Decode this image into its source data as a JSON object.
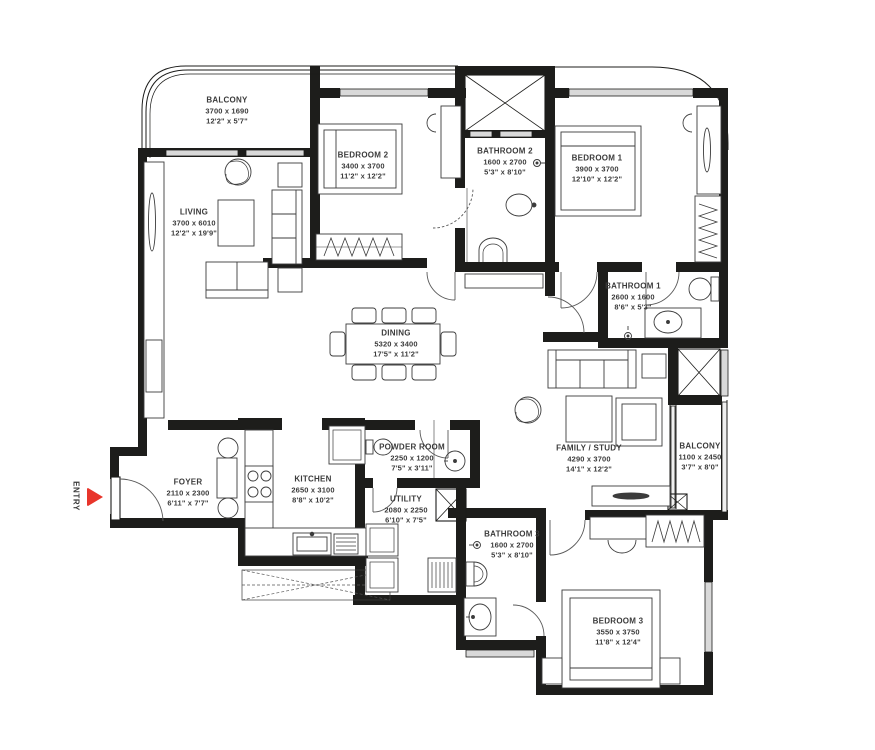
{
  "title": "Apartment floor plan",
  "colors": {
    "wall": "#1d1d1b",
    "text": "#3b3b3b",
    "window_fill": "#d9d9d9",
    "entry_red": "#e8352b"
  },
  "entry": {
    "label": "ENTRY"
  },
  "rooms": [
    {
      "id": "balcony-top",
      "name": "BALCONY",
      "metric": "3700 x 1690",
      "imperial": "12'2\" x 5'7\""
    },
    {
      "id": "bedroom-2",
      "name": "BEDROOM 2",
      "metric": "3400 x 3700",
      "imperial": "11'2\" x 12'2\""
    },
    {
      "id": "bathroom-2",
      "name": "BATHROOM 2",
      "metric": "1600 x 2700",
      "imperial": "5'3\" x 8'10\""
    },
    {
      "id": "bedroom-1",
      "name": "BEDROOM 1",
      "metric": "3900 x 3700",
      "imperial": "12'10\" x 12'2\""
    },
    {
      "id": "living",
      "name": "LIVING",
      "metric": "3700 x 6010",
      "imperial": "12'2\" x 19'9\""
    },
    {
      "id": "bathroom-1",
      "name": "BATHROOM 1",
      "metric": "2600 x 1600",
      "imperial": "8'6\" x 5'3\""
    },
    {
      "id": "dining",
      "name": "DINING",
      "metric": "5320 x 3400",
      "imperial": "17'5\" x 11'2\""
    },
    {
      "id": "family-study",
      "name": "FAMILY / STUDY",
      "metric": "4290 x 3700",
      "imperial": "14'1\" x 12'2\""
    },
    {
      "id": "balcony-right",
      "name": "BALCONY",
      "metric": "1100 x 2450",
      "imperial": "3'7\" x 8'0\""
    },
    {
      "id": "foyer",
      "name": "FOYER",
      "metric": "2110 x 2300",
      "imperial": "6'11\" x 7'7\""
    },
    {
      "id": "kitchen",
      "name": "KITCHEN",
      "metric": "2650 x 3100",
      "imperial": "8'8\" x 10'2\""
    },
    {
      "id": "powder-room",
      "name": "POWDER ROOM",
      "metric": "2250 x 1200",
      "imperial": "7'5\" x 3'11\""
    },
    {
      "id": "utility",
      "name": "UTILITY",
      "metric": "2080 x 2250",
      "imperial": "6'10\" x 7'5\""
    },
    {
      "id": "bathroom-3",
      "name": "BATHROOM 3",
      "metric": "1600 x 2700",
      "imperial": "5'3\" x 8'10\""
    },
    {
      "id": "bedroom-3",
      "name": "BEDROOM 3",
      "metric": "3550 x 3750",
      "imperial": "11'8\" x 12'4\""
    }
  ]
}
